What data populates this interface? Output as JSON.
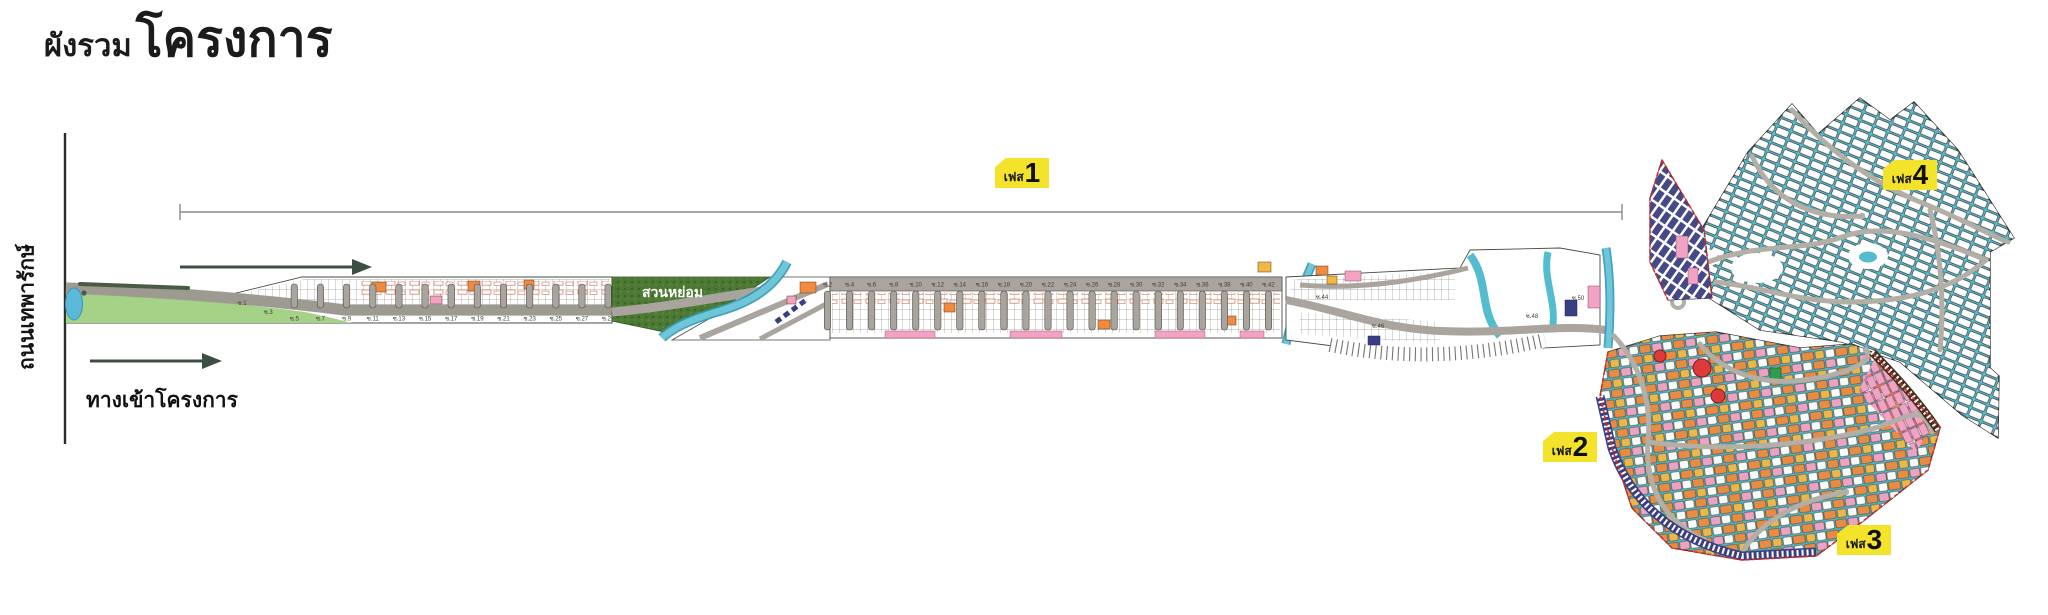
{
  "title": {
    "prefix": "ผังรวม",
    "main": "โครงการ"
  },
  "labels": {
    "main_road": "ถนนเทพารักษ์",
    "entrance": "ทางเข้าโครงการ",
    "park": "สวนหย่อม"
  },
  "phases": [
    {
      "prefix": "เฟส",
      "number": "1"
    },
    {
      "prefix": "เฟส",
      "number": "2"
    },
    {
      "prefix": "เฟส",
      "number": "3"
    },
    {
      "prefix": "เฟส",
      "number": "4"
    }
  ],
  "strip": {
    "segment1_sois": [
      "ซ.1",
      "ซ.3",
      "ซ.5",
      "ซ.7",
      "ซ.9",
      "ซ.11",
      "ซ.13",
      "ซ.15",
      "ซ.17",
      "ซ.19",
      "ซ.21",
      "ซ.23",
      "ซ.25",
      "ซ.27",
      "ซ.29"
    ],
    "segment2_sois": [
      "ซ.2",
      "ซ.4",
      "ซ.6",
      "ซ.8",
      "ซ.10",
      "ซ.12",
      "ซ.14",
      "ซ.16",
      "ซ.18",
      "ซ.20",
      "ซ.22",
      "ซ.24",
      "ซ.26",
      "ซ.28",
      "ซ.30",
      "ซ.32",
      "ซ.34",
      "ซ.36",
      "ซ.38",
      "ซ.40",
      "ซ.42"
    ],
    "segment3_sois": [
      "ซ.44",
      "ซ.46",
      "ซ.48",
      "ซ.50"
    ]
  },
  "colors": {
    "phase_label_bg": "#f4e32b",
    "teal_plots_bg": "#54bccf",
    "canal": "#6ec6d8",
    "lawn_green": "#a5d286",
    "park_green": "#4c7a34",
    "road_gray": "#a9a49d",
    "orange_plot": "#ef8a3e",
    "yellow_plot": "#f2b843",
    "pink_plot": "#f2a2c2",
    "navy_plot": "#3b3f82",
    "red_plot": "#dd3a3a",
    "boundary_red": "#cf2b2b"
  }
}
